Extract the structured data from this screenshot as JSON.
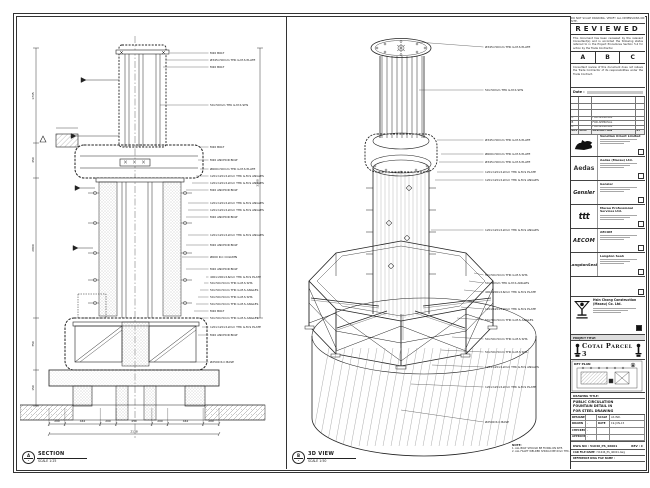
{
  "sheet": {
    "top_strip": "DO NOT SCALE DRAWING. VERIFY ALL DIMENSIONS ON SITE.",
    "reviewed": {
      "title": "REVIEWED",
      "p1": "This document has been reviewed by the relevant Consultant(s) and is accorded the following status referred to in the Project Procedures Section 5.4 for action by the Trade Contractor.",
      "options": [
        "A",
        "B",
        "C"
      ],
      "p2": "Consultant review of this document does not relieve the Trade Contractor of its responsibilities under the Trade Contract.",
      "date_label": "Date :"
    },
    "revisions": {
      "cols": [
        "REV",
        "DATE",
        "DESCRIPTION",
        "BY"
      ],
      "rows": [
        [
          "C",
          "",
          "FOR APPROVAL",
          ""
        ],
        [
          "B",
          "",
          "FOR APPROVAL",
          ""
        ],
        [
          "A",
          "",
          "FOR APPROVAL",
          ""
        ]
      ]
    },
    "stamps": [
      {
        "logo": "venetian",
        "logo_text": "",
        "name": "Venetian Orient Limited"
      },
      {
        "logo": "aedas",
        "logo_text": "Aedas",
        "name": "Aedas (Macau) Ltd."
      },
      {
        "logo": "gensler",
        "logo_text": "Gensler",
        "name": "Gensler"
      },
      {
        "logo": "ttt",
        "logo_text": "ttt",
        "name": "Macau Professional Services Ltd."
      },
      {
        "logo": "aecom",
        "logo_text": "AECOM",
        "name": "AECOM"
      },
      {
        "logo": "langdon",
        "logo_text": "LangdonSeah",
        "name": "Langdon Seah"
      }
    ],
    "contractor": {
      "name": "Hsin Chong Construction (Macau) Co. Ltd."
    },
    "project": {
      "label": "PROJECT TITLE:",
      "title": "Cotai Parcel 3"
    },
    "key_plan": {
      "label": "KEY PLAN"
    },
    "titleblock": {
      "drawing_title_label": "DRAWING TITLE:",
      "drawing_title_lines": [
        "PUBLIC CIRCULATION",
        "FOUNTAIN DETAIL IN",
        "FOR STEEL DRAWING"
      ],
      "fields": [
        [
          "DESIGNED",
          "",
          "SCALE",
          "AS IND."
        ],
        [
          "DRAWN",
          "-",
          "DATE",
          "19-JUN-15"
        ],
        [
          "CHECKED",
          "-",
          "",
          ""
        ],
        [
          "APPROVED",
          "-",
          "",
          ""
        ]
      ],
      "dwg_label": "DWG NO :",
      "dwg_no": "51646_PS_46001",
      "rev_label": "REV :",
      "rev": "C",
      "cad_label": "CAD FILE NAME :",
      "cad_file": "51646_PS_46001.dwg",
      "ref_label": "REFERENCE DWG FILE NAME :"
    }
  },
  "section_view": {
    "bubble": "A",
    "bubble_sub": "-",
    "title": "SECTION",
    "scale": "SCALE 1:25",
    "labels": [
      {
        "t": "M20 BOLT",
        "x": 190,
        "y": 36,
        "lx": 150
      },
      {
        "t": "Ø345×50mm THK G.M.S PLATE",
        "x": 190,
        "y": 43,
        "lx": 146
      },
      {
        "t": "M20 BOLT",
        "x": 190,
        "y": 50,
        "lx": 143
      },
      {
        "t": "50×50mm THK G.M.S SHS",
        "x": 190,
        "y": 88,
        "lx": 140
      },
      {
        "t": "M20 BOLT",
        "x": 190,
        "y": 130,
        "lx": 180
      },
      {
        "t": "M20 ANCHOR BOLT",
        "x": 190,
        "y": 143,
        "lx": 178
      },
      {
        "t": "Ø600×50mm THK G.M.S PLATE",
        "x": 190,
        "y": 152,
        "lx": 180
      },
      {
        "t": "120×120×12mm THK G.M.S ANGLES",
        "x": 190,
        "y": 159,
        "lx": 176
      },
      {
        "t": "120×120×12mm THK G.M.S ANGLES",
        "x": 190,
        "y": 166,
        "lx": 172
      },
      {
        "t": "M20 ANCHOR BOLT",
        "x": 190,
        "y": 173,
        "lx": 166
      },
      {
        "t": "120×120×12mm THK G.M.S ANGLES",
        "x": 190,
        "y": 186,
        "lx": 168
      },
      {
        "t": "120×120×12mm THK G.M.S ANGLES",
        "x": 190,
        "y": 193,
        "lx": 168
      },
      {
        "t": "M20 ANCHOR BOLT",
        "x": 190,
        "y": 200,
        "lx": 166
      },
      {
        "t": "120×120×12mm THK G.M.S ANGLES",
        "x": 190,
        "y": 218,
        "lx": 168
      },
      {
        "t": "M20 ANCHOR BOLT",
        "x": 190,
        "y": 228,
        "lx": 166
      },
      {
        "t": "Ø600 R.C COLUMN",
        "x": 190,
        "y": 240,
        "lx": 162
      },
      {
        "t": "M20 ANCHOR BOLT",
        "x": 190,
        "y": 252,
        "lx": 166
      },
      {
        "t": "400×200×16mm THK G.M.S PLATE",
        "x": 190,
        "y": 260,
        "lx": 186
      },
      {
        "t": "50×50×5mm THK G.M.S SHS",
        "x": 190,
        "y": 266,
        "lx": 184
      },
      {
        "t": "50×50×5mm THK G.M.S ANGLES",
        "x": 190,
        "y": 273,
        "lx": 180
      },
      {
        "t": "50×50×5mm THK G.M.S SHS",
        "x": 190,
        "y": 280,
        "lx": 178
      },
      {
        "t": "50×50×5mm THK G.M.S ANGLES",
        "x": 190,
        "y": 287,
        "lx": 176
      },
      {
        "t": "M20 BOLT",
        "x": 190,
        "y": 294,
        "lx": 174
      },
      {
        "t": "50×50×5mm THK G.M.S ANGLES",
        "x": 190,
        "y": 301,
        "lx": 176
      },
      {
        "t": "120×120×12mm THK G.M.S PLATE",
        "x": 190,
        "y": 310,
        "lx": 182
      },
      {
        "t": "M20 ANCHOR BOLT",
        "x": 190,
        "y": 318,
        "lx": 178
      },
      {
        "t": "Ø2500 R.C BASE",
        "x": 190,
        "y": 345,
        "lx": 170
      }
    ],
    "dims": [
      {
        "t": "200",
        "x": 37,
        "y": 404,
        "a": "middle"
      },
      {
        "t": "444",
        "x": 62.5,
        "y": 404,
        "a": "middle"
      },
      {
        "t": "200",
        "x": 88,
        "y": 404,
        "a": "middle"
      },
      {
        "t": "450",
        "x": 114,
        "y": 404,
        "a": "middle"
      },
      {
        "t": "200",
        "x": 140,
        "y": 404,
        "a": "middle"
      },
      {
        "t": "444",
        "x": 165.5,
        "y": 404,
        "a": "middle"
      },
      {
        "t": "200",
        "x": 191,
        "y": 404,
        "a": "middle"
      },
      {
        "t": "2138",
        "x": 114,
        "y": 414.5,
        "a": "middle"
      },
      {
        "t": "1745",
        "x": 14,
        "y": 78,
        "a": "middle",
        "r": -90
      },
      {
        "t": "450",
        "x": 14,
        "y": 142,
        "a": "middle",
        "r": -90
      },
      {
        "t": "2800",
        "x": 14,
        "y": 230,
        "a": "middle",
        "r": -90
      },
      {
        "t": "750",
        "x": 14,
        "y": 326,
        "a": "middle",
        "r": -90
      },
      {
        "t": "150",
        "x": 14,
        "y": 370,
        "a": "middle",
        "r": -90
      },
      {
        "t": "3300",
        "x": 238.5,
        "y": 165,
        "a": "middle",
        "r": -90
      }
    ]
  },
  "iso_view": {
    "bubble": "B",
    "bubble_sub": "-",
    "title": "3D VIEW",
    "scale": "SCALE 1:50",
    "labels": [
      {
        "t": "Ø345×50mm THK G.M.S PLATE",
        "x": 196,
        "y": 30,
        "lx": 128,
        "ly": 24
      },
      {
        "t": "50×50mm THK G.M.S SHS",
        "x": 196,
        "y": 73,
        "lx": 130,
        "ly": 72
      },
      {
        "t": "Ø345×50mm THK G.M.S PLATE",
        "x": 196,
        "y": 123,
        "lx": 148,
        "ly": 122
      },
      {
        "t": "Ø600×50mm THK G.M.S PLATE",
        "x": 196,
        "y": 137,
        "lx": 152,
        "ly": 136
      },
      {
        "t": "Ø345×50mm THK G.M.S PLATE",
        "x": 196,
        "y": 145,
        "lx": 150,
        "ly": 144
      },
      {
        "t": "120×120×12mm THK G.M.S PLATE",
        "x": 196,
        "y": 155,
        "lx": 148,
        "ly": 154
      },
      {
        "t": "120×120×12mm THK G.M.S ANGLES",
        "x": 196,
        "y": 163,
        "lx": 146,
        "ly": 162
      },
      {
        "t": "120×120×12mm THK G.M.S ANGLES",
        "x": 196,
        "y": 213,
        "lx": 142,
        "ly": 212
      },
      {
        "t": "50×50×5mm THK G.M.S SHS",
        "x": 196,
        "y": 258,
        "lx": 185,
        "ly": 255
      },
      {
        "t": "50×50mm THK G.M.S ANGLES",
        "x": 196,
        "y": 266,
        "lx": 180,
        "ly": 263
      },
      {
        "t": "400×200×16mm THK G.M.S PLATE",
        "x": 196,
        "y": 275,
        "lx": 175,
        "ly": 272
      },
      {
        "t": "120×120×12mm THK G.M.S PLATE",
        "x": 196,
        "y": 292,
        "lx": 172,
        "ly": 289
      },
      {
        "t": "50×50×5mm THK G.M.S ANGLES",
        "x": 196,
        "y": 303,
        "lx": 168,
        "ly": 300
      },
      {
        "t": "50×50×5mm THK G.M.S SHS",
        "x": 196,
        "y": 322,
        "lx": 163,
        "ly": 319
      },
      {
        "t": "50×50×5mm THK G.M.S SHS",
        "x": 196,
        "y": 335,
        "lx": 152,
        "ly": 332
      },
      {
        "t": "120×120×12mm THK G.M.S ANGLES",
        "x": 196,
        "y": 350,
        "lx": 143,
        "ly": 347
      },
      {
        "t": "120×120×12mm THK G.M.S PLATE",
        "x": 196,
        "y": 370,
        "lx": 122,
        "ly": 366
      },
      {
        "t": "Ø2500 R.C BASE",
        "x": 196,
        "y": 405,
        "lx": 112,
        "ly": 392
      }
    ],
    "note": {
      "title": "NOTE:",
      "lines": [
        "1. ALL BOLT SHOULD BE FIXING ON SITE.",
        "2. ALL FILLET WELDED SHOULD BE 6mm THK."
      ]
    }
  }
}
